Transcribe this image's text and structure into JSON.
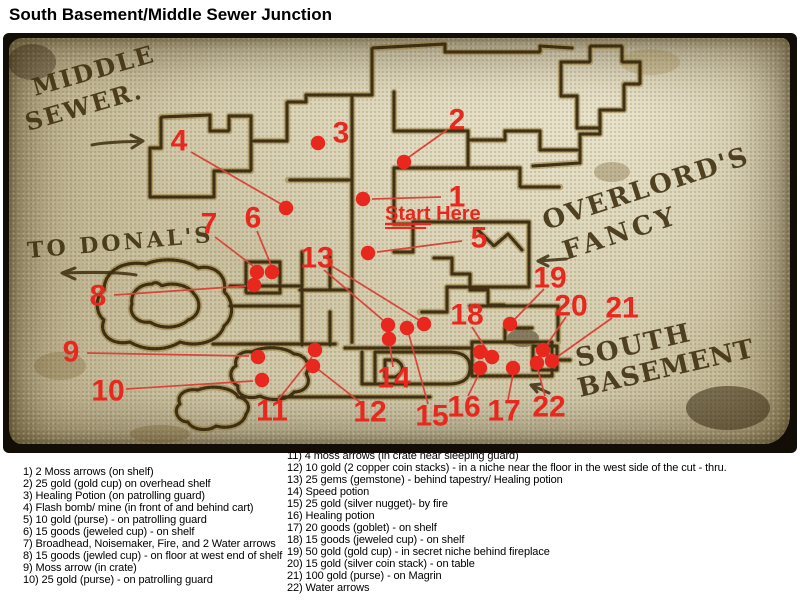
{
  "title": "South Basement/Middle Sewer Junction",
  "colors": {
    "marker_red": "#e8281e",
    "leader_red": "#d8453a",
    "ink": "#3c2d0d",
    "wall_dark": "#33250a",
    "wall_light": "#8f7330",
    "parchment": "#d6cfae"
  },
  "map": {
    "labels": {
      "middle": "MIDDLE",
      "sewer": "SEWER.",
      "to_donals": "TO DONAL'S",
      "overlords": "OVERLORD'S",
      "fancy": "FANCY",
      "south": "SOUTH",
      "basement": "BASEMENT",
      "start_here": "Start Here"
    },
    "markers": [
      {
        "n": "1",
        "nx": 457,
        "ny": 197,
        "dots": [
          [
            363,
            199
          ]
        ],
        "lines": [
          [
            [
              441,
              197
            ],
            [
              372,
              199
            ]
          ]
        ]
      },
      {
        "n": "2",
        "nx": 457,
        "ny": 120,
        "dots": [
          [
            404,
            162
          ]
        ],
        "lines": [
          [
            [
              447,
              130
            ],
            [
              409,
              157
            ]
          ]
        ]
      },
      {
        "n": "3",
        "nx": 341,
        "ny": 133,
        "dots": [
          [
            318,
            143
          ]
        ],
        "lines": []
      },
      {
        "n": "4",
        "nx": 179,
        "ny": 141,
        "dots": [
          [
            286,
            208
          ]
        ],
        "lines": [
          [
            [
              191,
              152
            ],
            [
              281,
              204
            ]
          ]
        ]
      },
      {
        "n": "5",
        "nx": 479,
        "ny": 238,
        "dots": [
          [
            368,
            253
          ]
        ],
        "lines": [
          [
            [
              462,
              241
            ],
            [
              377,
              252
            ]
          ]
        ]
      },
      {
        "n": "6",
        "nx": 253,
        "ny": 218,
        "dots": [
          [
            272,
            272
          ]
        ],
        "lines": [
          [
            [
              257,
              231
            ],
            [
              271,
              265
            ]
          ]
        ]
      },
      {
        "n": "7",
        "nx": 209,
        "ny": 224,
        "dots": [
          [
            257,
            272
          ]
        ],
        "lines": [
          [
            [
              215,
              237
            ],
            [
              253,
              266
            ]
          ]
        ]
      },
      {
        "n": "8",
        "nx": 98,
        "ny": 296,
        "dots": [
          [
            254,
            285
          ]
        ],
        "lines": [
          [
            [
              114,
              295
            ],
            [
              246,
              286
            ]
          ]
        ]
      },
      {
        "n": "9",
        "nx": 71,
        "ny": 352,
        "dots": [
          [
            258,
            357
          ]
        ],
        "lines": [
          [
            [
              87,
              353
            ],
            [
              249,
              356
            ]
          ]
        ]
      },
      {
        "n": "10",
        "nx": 108,
        "ny": 391,
        "dots": [
          [
            262,
            380
          ]
        ],
        "lines": [
          [
            [
              126,
              389
            ],
            [
              253,
              381
            ]
          ]
        ]
      },
      {
        "n": "11",
        "nx": 272,
        "ny": 411,
        "dots": [
          [
            315,
            350
          ]
        ],
        "lines": [
          [
            [
              278,
              400
            ],
            [
              312,
              357
            ]
          ]
        ]
      },
      {
        "n": "12",
        "nx": 370,
        "ny": 412,
        "dots": [
          [
            313,
            366
          ]
        ],
        "lines": [
          [
            [
              361,
              403
            ],
            [
              319,
              370
            ]
          ]
        ]
      },
      {
        "n": "13",
        "nx": 317,
        "ny": 258,
        "dots": [
          [
            388,
            325
          ],
          [
            424,
            324
          ]
        ],
        "lines": [
          [
            [
              324,
              270
            ],
            [
              384,
              321
            ]
          ],
          [
            [
              330,
              265
            ],
            [
              419,
              320
            ]
          ]
        ]
      },
      {
        "n": "14",
        "nx": 394,
        "ny": 378,
        "dots": [
          [
            389,
            339
          ]
        ],
        "lines": [
          [
            [
              393,
              367
            ],
            [
              390,
              346
            ]
          ]
        ]
      },
      {
        "n": "15",
        "nx": 432,
        "ny": 416,
        "dots": [
          [
            407,
            328
          ]
        ],
        "lines": [
          [
            [
              428,
              404
            ],
            [
              409,
              335
            ]
          ]
        ]
      },
      {
        "n": "16",
        "nx": 464,
        "ny": 407,
        "dots": [
          [
            480,
            368
          ]
        ],
        "lines": [
          [
            [
              468,
              396
            ],
            [
              479,
              374
            ]
          ]
        ]
      },
      {
        "n": "17",
        "nx": 504,
        "ny": 411,
        "dots": [
          [
            513,
            368
          ]
        ],
        "lines": [
          [
            [
              508,
              400
            ],
            [
              513,
              374
            ]
          ]
        ]
      },
      {
        "n": "18",
        "nx": 467,
        "ny": 315,
        "dots": [
          [
            480,
            352
          ],
          [
            492,
            357
          ]
        ],
        "lines": [
          [
            [
              472,
              327
            ],
            [
              488,
              352
            ]
          ]
        ]
      },
      {
        "n": "19",
        "nx": 550,
        "ny": 278,
        "dots": [
          [
            510,
            324
          ]
        ],
        "lines": [
          [
            [
              544,
              289
            ],
            [
              514,
              320
            ]
          ]
        ]
      },
      {
        "n": "20",
        "nx": 571,
        "ny": 306,
        "dots": [
          [
            543,
            350
          ]
        ],
        "lines": [
          [
            [
              566,
              317
            ],
            [
              546,
              346
            ]
          ]
        ]
      },
      {
        "n": "21",
        "nx": 622,
        "ny": 308,
        "dots": [
          [
            552,
            361
          ]
        ],
        "lines": [
          [
            [
              612,
              318
            ],
            [
              557,
              357
            ]
          ]
        ]
      },
      {
        "n": "22",
        "nx": 549,
        "ny": 407,
        "dots": [
          [
            537,
            363
          ]
        ],
        "lines": [
          [
            [
              545,
              396
            ],
            [
              538,
              370
            ]
          ]
        ]
      }
    ]
  },
  "legend": {
    "left": [
      "1) 2 Moss arrows (on shelf)",
      "2) 25 gold (gold cup) on overhead shelf",
      "3) Healing Potion (on patrolling guard)",
      "4) Flash bomb/ mine (in front of and behind cart)",
      "5) 10 gold (purse) - on patrolling guard",
      "6) 15 goods (jeweled cup) - on shelf",
      "7) Broadhead, Noisemaker, Fire, and 2 Water arrows",
      "8) 15 goods (jewled cup) - on floor at west end of shelf",
      "9) Moss arrow (in crate)",
      "10) 25 gold (purse) - on patrolling guard"
    ],
    "right": [
      "11) 4 moss arrows (in crate near sleeping guard)",
      "12) 10 gold (2 copper coin stacks) - in a niche near the floor in the west side of the cut - thru.",
      "13) 25 gems (gemstone) - behind tapestry/ Healing potion",
      "14) Speed potion",
      "15) 25 gold (silver nugget)- by fire",
      "16) Healing potion",
      "17) 20 goods (goblet) - on shelf",
      "18) 15 goods (jeweled cup) - on shelf",
      "19) 50 gold (gold cup) - in secret niche behind fireplace",
      "20) 15 gold (silver coin stack) - on table",
      "21) 100 gold (purse) - on Magrin",
      "22) Water arrows"
    ]
  }
}
